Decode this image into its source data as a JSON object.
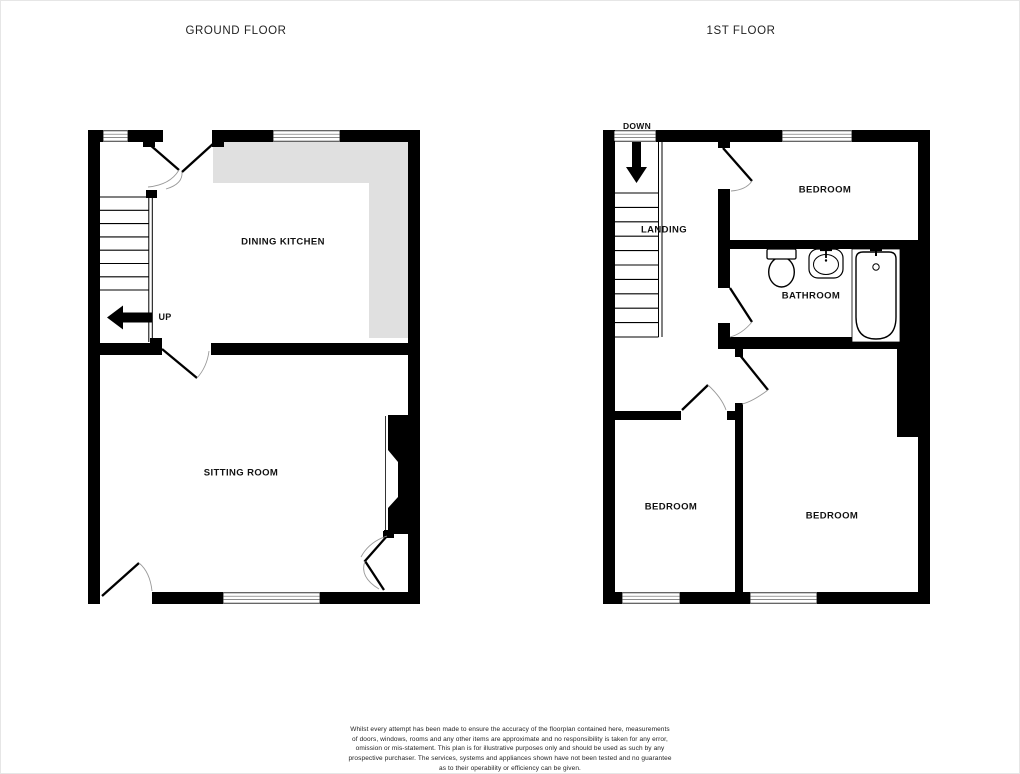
{
  "titles": {
    "ground": "GROUND FLOOR",
    "first": "1ST FLOOR"
  },
  "ground_floor": {
    "dining_kitchen": "DINING KITCHEN",
    "sitting_room": "SITTING ROOM",
    "up": "UP"
  },
  "first_floor": {
    "landing": "LANDING",
    "bedroom_top": "BEDROOM",
    "bathroom": "BATHROOM",
    "bedroom_left": "BEDROOM",
    "bedroom_right": "BEDROOM",
    "down": "DOWN"
  },
  "disclaimer": {
    "lines": [
      "Whilst every attempt has been made to ensure the accuracy of the floorplan contained here, measurements",
      "of doors, windows, rooms and any other items are approximate and no responsibility is taken for any error,",
      "omission or mis-statement. This plan is for illustrative purposes only and should be used as such by any",
      "prospective purchaser. The services, systems and appliances shown have not been tested and no guarantee",
      "as to their operability or efficiency can be given.",
      "Made with Metropix ©2025"
    ]
  },
  "colors": {
    "wall": "#000000",
    "counter": "#e0e0e0",
    "door_arc": "#999999",
    "background": "#ffffff"
  }
}
